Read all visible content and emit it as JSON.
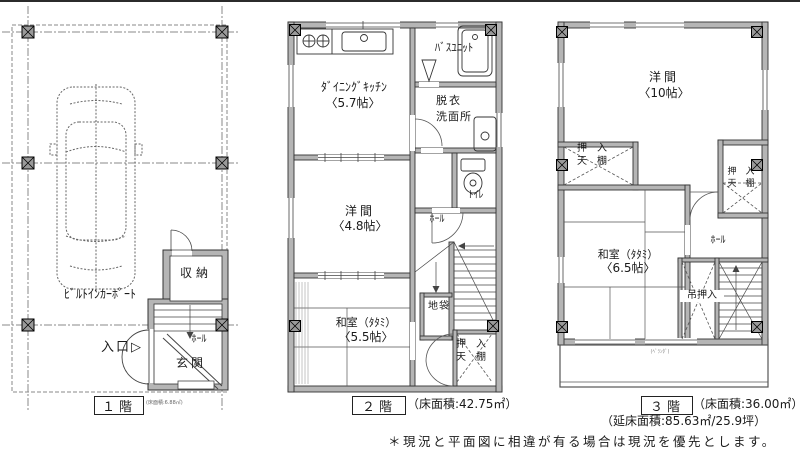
{
  "colors": {
    "wall": "#b5b5b5",
    "line": "#3c3c3c",
    "bg": "#ffffff"
  },
  "floor1": {
    "carport": "ﾋﾞﾙﾄｲﾝｶｰﾎﾟｰﾄ",
    "entrance": "入口▷",
    "storage": "収納",
    "hall": "ﾎｰﾙ",
    "genkan": "玄関",
    "tag": "１階",
    "area_note": "(床面積:6.88㎡)"
  },
  "floor2": {
    "dk1": "ﾀﾞｲﾆﾝｸﾞｷｯﾁﾝ",
    "dk2": "〈5.7帖〉",
    "bath": "ﾊﾞｽﾕﾆｯﾄ",
    "datsui": "脱衣",
    "senmenjo": "洗面所",
    "toilet": "ﾄｲﾚ",
    "youma1": "洋間",
    "youma2": "〈4.8帖〉",
    "hall": "ﾎｰﾙ",
    "jibukuro": "地袋",
    "washitsu1": "和室（ﾀﾀﾐ）",
    "washitsu2": "〈5.5帖〉",
    "closet_line1": "押　入",
    "closet_line2": "天　棚",
    "tag": "２階",
    "area": "（床面積:42.75㎡）"
  },
  "floor3": {
    "youma1": "洋間",
    "youma2": "〈10帖〉",
    "closet_left1": "押　入",
    "closet_left2": "天　棚",
    "closet_right1": "押　入",
    "closet_right2": "天　棚",
    "washitsu1": "和室（ﾀﾀﾐ）",
    "washitsu2": "〈6.5帖〉",
    "hall": "ﾎｰﾙ",
    "tsuri_oshiire": "吊押入",
    "veranda": "(ﾍﾞﾗﾝﾀﾞ)",
    "tag": "３階",
    "area": "（床面積:36.00㎡）"
  },
  "footer": {
    "total_area": "（延床面積:85.63㎡/25.9坪）",
    "note": "＊現況と平面図に相違が有る場合は現況を優先とします。"
  }
}
